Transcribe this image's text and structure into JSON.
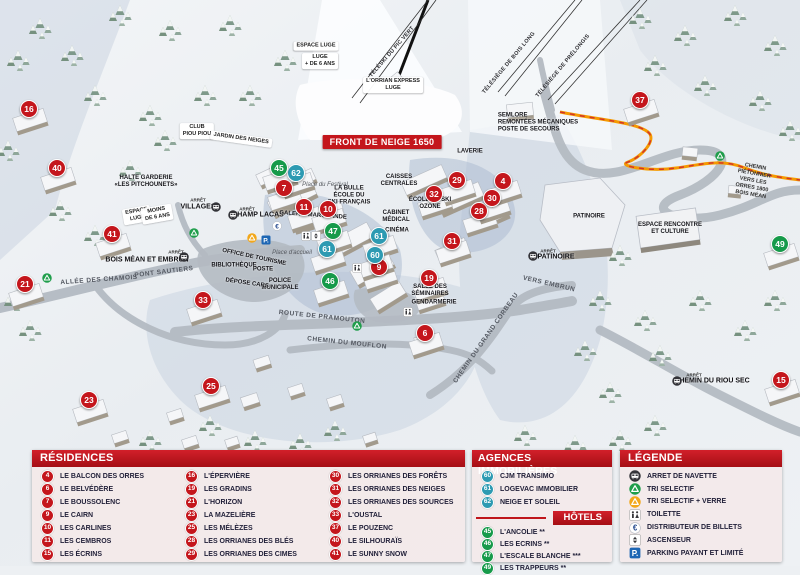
{
  "map": {
    "banner": "FRONT DE NEIGE 1650",
    "colors": {
      "residence": "#c4161c",
      "agency": "#2d9ab2",
      "hotel": "#169a4a",
      "header_red": "#b5121b",
      "path_orange": "#f59a00"
    },
    "markers": [
      {
        "n": "16",
        "type": "res",
        "x": 28,
        "y": 108
      },
      {
        "n": "40",
        "type": "res",
        "x": 56,
        "y": 167
      },
      {
        "n": "41",
        "type": "res",
        "x": 111,
        "y": 233
      },
      {
        "n": "21",
        "type": "res",
        "x": 24,
        "y": 283
      },
      {
        "n": "23",
        "type": "res",
        "x": 88,
        "y": 399
      },
      {
        "n": "25",
        "type": "res",
        "x": 210,
        "y": 385
      },
      {
        "n": "33",
        "type": "res",
        "x": 202,
        "y": 299
      },
      {
        "n": "7",
        "type": "res",
        "x": 283,
        "y": 187
      },
      {
        "n": "11",
        "type": "res",
        "x": 303,
        "y": 206
      },
      {
        "n": "10",
        "type": "res",
        "x": 327,
        "y": 208
      },
      {
        "n": "9",
        "type": "res",
        "x": 378,
        "y": 266
      },
      {
        "n": "6",
        "type": "res",
        "x": 424,
        "y": 332
      },
      {
        "n": "19",
        "type": "res",
        "x": 428,
        "y": 277
      },
      {
        "n": "32",
        "type": "res",
        "x": 433,
        "y": 193
      },
      {
        "n": "29",
        "type": "res",
        "x": 456,
        "y": 179
      },
      {
        "n": "31",
        "type": "res",
        "x": 451,
        "y": 240
      },
      {
        "n": "28",
        "type": "res",
        "x": 478,
        "y": 210
      },
      {
        "n": "30",
        "type": "res",
        "x": 491,
        "y": 197
      },
      {
        "n": "4",
        "type": "res",
        "x": 502,
        "y": 180
      },
      {
        "n": "37",
        "type": "res",
        "x": 639,
        "y": 99
      },
      {
        "n": "15",
        "type": "res",
        "x": 780,
        "y": 379
      },
      {
        "n": "62",
        "type": "agency",
        "x": 295,
        "y": 172
      },
      {
        "n": "61",
        "type": "agency",
        "x": 326,
        "y": 248
      },
      {
        "n": "61",
        "type": "agency",
        "x": 378,
        "y": 235
      },
      {
        "n": "60",
        "type": "agency",
        "x": 374,
        "y": 254
      },
      {
        "n": "45",
        "type": "hotel",
        "x": 278,
        "y": 167
      },
      {
        "n": "47",
        "type": "hotel",
        "x": 332,
        "y": 230
      },
      {
        "n": "46",
        "type": "hotel",
        "x": 329,
        "y": 280
      },
      {
        "n": "49",
        "type": "hotel",
        "x": 779,
        "y": 243
      }
    ],
    "labels": [
      {
        "text": "FRONT DE NEIGE 1650",
        "x": 382,
        "y": 142,
        "rot": 0,
        "cls": "banner"
      },
      {
        "text": "L'ORRIAN EXPRESS\nLUGE",
        "x": 393,
        "y": 85,
        "rot": 0,
        "cls": "pill"
      },
      {
        "text": "TÉLÉSKI DU PIC VERT",
        "x": 392,
        "y": 52,
        "rot": -49,
        "cls": "lift"
      },
      {
        "text": "TÉLÉSIÈGE DE BOIS LONG",
        "x": 509,
        "y": 63,
        "rot": -50,
        "cls": "lift"
      },
      {
        "text": "TÉLÉSIÈGE DE PRÉLONGIS",
        "x": 563,
        "y": 66,
        "rot": -50,
        "cls": "lift"
      },
      {
        "text": "SEMLORE\nREMONTÉES MÉCANIQUES\nPOSTE DE SECOURS",
        "x": 538,
        "y": 123,
        "rot": 0,
        "cls": "bold left"
      },
      {
        "text": "CLUB\nPIOU PIOU",
        "x": 197,
        "y": 131,
        "rot": 0,
        "cls": "pill"
      },
      {
        "text": "JARDIN DES NEIGES",
        "x": 241,
        "y": 139,
        "rot": 8,
        "cls": "pill"
      },
      {
        "text": "HALTE GARDERIE\n«LES PITCHOUNETS»",
        "x": 146,
        "y": 182,
        "rot": 0,
        "cls": "bold"
      },
      {
        "text": "ESPACE\nLUGE",
        "x": 137,
        "y": 215,
        "rot": -10,
        "cls": "pill"
      },
      {
        "text": "MOINS\nDE 6 ANS",
        "x": 157,
        "y": 214,
        "rot": -10,
        "cls": "pill"
      },
      {
        "text": "ESPACE LUGE",
        "x": 316,
        "y": 46,
        "rot": 0,
        "cls": "pill"
      },
      {
        "text": "LUGE\n+ DE 6 ANS",
        "x": 320,
        "y": 61,
        "rot": 0,
        "cls": "pill"
      },
      {
        "text": "ARRÊT",
        "x": 198,
        "y": 200,
        "rot": 0,
        "cls": "tiny"
      },
      {
        "text": "VILLAGES",
        "x": 198,
        "y": 207,
        "rot": 0,
        "cls": "stop"
      },
      {
        "text": "ARRÊT",
        "x": 247,
        "y": 209,
        "rot": 0,
        "cls": "tiny"
      },
      {
        "text": "CHAMP LACAS",
        "x": 258,
        "y": 215,
        "rot": 0,
        "cls": "stop"
      },
      {
        "text": "ARRÊT",
        "x": 176,
        "y": 252,
        "rot": 0,
        "cls": "tiny"
      },
      {
        "text": "BOIS MÉAN ET EMBRUN",
        "x": 147,
        "y": 260,
        "rot": 0,
        "cls": "stop"
      },
      {
        "text": "ARRÊT",
        "x": 548,
        "y": 251,
        "rot": 0,
        "cls": "tiny"
      },
      {
        "text": "PATINOIRE",
        "x": 556,
        "y": 257,
        "rot": 0,
        "cls": "stop"
      },
      {
        "text": "ARRÊT",
        "x": 694,
        "y": 375,
        "rot": 0,
        "cls": "tiny"
      },
      {
        "text": "CHEMIN DU RIOU SEC",
        "x": 712,
        "y": 381,
        "rot": 0,
        "cls": "stop"
      },
      {
        "text": "GALERIE MARCHANDE",
        "x": 313,
        "y": 216,
        "rot": 4,
        "cls": "bold"
      },
      {
        "text": "LA BULLE\nÉCOLE DU\nSKI FRANÇAIS",
        "x": 349,
        "y": 196,
        "rot": 0,
        "cls": "bold"
      },
      {
        "text": "Place du Festival",
        "x": 325,
        "y": 185,
        "rot": 0,
        "cls": "ital"
      },
      {
        "text": "Place d'accueil",
        "x": 292,
        "y": 253,
        "rot": 0,
        "cls": "ital"
      },
      {
        "text": "OFFICE DE TOURISME",
        "x": 254,
        "y": 258,
        "rot": 12,
        "cls": "bold"
      },
      {
        "text": "BIBLIOTHÈQUE",
        "x": 234,
        "y": 266,
        "rot": 0,
        "cls": "bold"
      },
      {
        "text": "POSTE",
        "x": 263,
        "y": 270,
        "rot": 0,
        "cls": "bold"
      },
      {
        "text": "POLICE\nMUNICIPALE",
        "x": 280,
        "y": 285,
        "rot": 0,
        "cls": "bold"
      },
      {
        "text": "DÉPOSE CARS",
        "x": 247,
        "y": 284,
        "rot": 8,
        "cls": "bold"
      },
      {
        "text": "ALLÉE DES CHAMOIS",
        "x": 99,
        "y": 280,
        "rot": -4,
        "cls": "road"
      },
      {
        "text": "PONT SAUTIERS",
        "x": 164,
        "y": 272,
        "rot": -7,
        "cls": "road"
      },
      {
        "text": "ROUTE DE PRAMOUTON",
        "x": 322,
        "y": 317,
        "rot": 6,
        "cls": "road"
      },
      {
        "text": "CHEMIN DU MOUFLON",
        "x": 347,
        "y": 343,
        "rot": 6,
        "cls": "road"
      },
      {
        "text": "CHEMIN DU GRAND CORBEAU",
        "x": 486,
        "y": 338,
        "rot": -55,
        "cls": "road"
      },
      {
        "text": "VERS EMBRUN",
        "x": 549,
        "y": 284,
        "rot": 13,
        "cls": "road"
      },
      {
        "text": "LAVERIE",
        "x": 470,
        "y": 152,
        "rot": 0,
        "cls": "bold"
      },
      {
        "text": "CAISSES\nCENTRALES",
        "x": 399,
        "y": 181,
        "rot": 0,
        "cls": "bold"
      },
      {
        "text": "ÉCOLE DE SKI\nOZONE",
        "x": 430,
        "y": 204,
        "rot": 0,
        "cls": "bold"
      },
      {
        "text": "CABINET\nMÉDICAL",
        "x": 396,
        "y": 217,
        "rot": 0,
        "cls": "bold"
      },
      {
        "text": "CINÉMA",
        "x": 397,
        "y": 231,
        "rot": 0,
        "cls": "bold"
      },
      {
        "text": "SALLE DES\nSÉMINAIRES",
        "x": 430,
        "y": 291,
        "rot": 0,
        "cls": "bold"
      },
      {
        "text": "GENDARMERIE",
        "x": 434,
        "y": 303,
        "rot": 0,
        "cls": "bold"
      },
      {
        "text": "PATINOIRE",
        "x": 589,
        "y": 217,
        "rot": 0,
        "cls": "bold"
      },
      {
        "text": "ESPACE RENCONTRE\nET CULTURE",
        "x": 670,
        "y": 229,
        "rot": 0,
        "cls": "bold"
      },
      {
        "text": "CHEMIN PIÉTONNIER\nVERS LES ORRES 1800\nBOIS MÉAN",
        "x": 753,
        "y": 181,
        "rot": 10,
        "cls": "tinyroad"
      }
    ],
    "icons": [
      {
        "name": "bus-icon",
        "x": 216,
        "y": 207
      },
      {
        "name": "bus-icon",
        "x": 233,
        "y": 215
      },
      {
        "name": "bus-icon",
        "x": 184,
        "y": 257
      },
      {
        "name": "bus-icon",
        "x": 533,
        "y": 256
      },
      {
        "name": "bus-icon",
        "x": 677,
        "y": 381
      },
      {
        "name": "recycle-green-icon",
        "x": 194,
        "y": 233
      },
      {
        "name": "recycle-green-icon",
        "x": 47,
        "y": 278
      },
      {
        "name": "recycle-green-icon",
        "x": 357,
        "y": 326
      },
      {
        "name": "recycle-green-icon",
        "x": 720,
        "y": 156
      },
      {
        "name": "recycle-yellow-icon",
        "x": 252,
        "y": 238
      },
      {
        "name": "parking-icon",
        "x": 266,
        "y": 240
      },
      {
        "name": "euro-icon",
        "x": 277,
        "y": 226
      },
      {
        "name": "wc-icon",
        "x": 306,
        "y": 236
      },
      {
        "name": "elevator-icon",
        "x": 316,
        "y": 236
      },
      {
        "name": "wc-icon",
        "x": 357,
        "y": 268
      },
      {
        "name": "wc-icon",
        "x": 408,
        "y": 312
      }
    ]
  },
  "panels": {
    "residences": {
      "title": "RÉSIDENCES",
      "columns": [
        [
          {
            "n": "4",
            "type": "res",
            "label": "LE BALCON DES ORRES"
          },
          {
            "n": "6",
            "type": "res",
            "label": "LE BELVÉDÈRE"
          },
          {
            "n": "7",
            "type": "res",
            "label": "LE BOUSSOLENC"
          },
          {
            "n": "9",
            "type": "res",
            "label": "LE CAIRN"
          },
          {
            "n": "10",
            "type": "res",
            "label": "LES CARLINES"
          },
          {
            "n": "11",
            "type": "res",
            "label": "LES CEMBROS"
          },
          {
            "n": "15",
            "type": "res",
            "label": "LES ÉCRINS"
          }
        ],
        [
          {
            "n": "16",
            "type": "res",
            "label": "L'ÉPERVIÈRE"
          },
          {
            "n": "19",
            "type": "res",
            "label": "LES GRADINS"
          },
          {
            "n": "21",
            "type": "res",
            "label": "L'HORIZON"
          },
          {
            "n": "23",
            "type": "res",
            "label": "LA MAZELIÈRE"
          },
          {
            "n": "25",
            "type": "res",
            "label": "LES MÉLÈZES"
          },
          {
            "n": "28",
            "type": "res",
            "label": "LES ORRIANES DES BLÉS"
          },
          {
            "n": "29",
            "type": "res",
            "label": "LES ORRIANES DES CIMES"
          }
        ],
        [
          {
            "n": "30",
            "type": "res",
            "label": "LES ORRIANES DES FORÊTS"
          },
          {
            "n": "31",
            "type": "res",
            "label": "LES ORRIANES DES NEIGES"
          },
          {
            "n": "32",
            "type": "res",
            "label": "LES ORRIANES DES SOURCES"
          },
          {
            "n": "33",
            "type": "res",
            "label": "L'OUSTAL"
          },
          {
            "n": "37",
            "type": "res",
            "label": "LE POUZENC"
          },
          {
            "n": "40",
            "type": "res",
            "label": "LE SILHOURAÏS"
          },
          {
            "n": "41",
            "type": "res",
            "label": "LE SUNNY SNOW"
          }
        ]
      ]
    },
    "agences": {
      "title": "AGENCES IMMOBILIÈRES",
      "items": [
        {
          "n": "60",
          "type": "agency",
          "label": "CJM TRANSIMO"
        },
        {
          "n": "61",
          "type": "agency",
          "label": "LOGEVAC IMMOBILIER"
        },
        {
          "n": "62",
          "type": "agency",
          "label": "NEIGE ET SOLEIL"
        }
      ]
    },
    "hotels": {
      "title": "HÔTELS",
      "items": [
        {
          "n": "45",
          "type": "hotel",
          "label": "L'ANCOLIE **"
        },
        {
          "n": "46",
          "type": "hotel",
          "label": "LES ECRINS **"
        },
        {
          "n": "47",
          "type": "hotel",
          "label": "L'ESCALE BLANCHE ***"
        },
        {
          "n": "49",
          "type": "hotel",
          "label": "LES TRAPPEURS **"
        }
      ]
    },
    "legende": {
      "title": "LÉGENDE",
      "items": [
        {
          "icon": "bus-icon",
          "label": "ARRET DE NAVETTE"
        },
        {
          "icon": "recycle-green-icon",
          "label": "TRI SELECTIF"
        },
        {
          "icon": "recycle-yellow-icon",
          "label": "TRI SELECTIF + VERRE"
        },
        {
          "icon": "wc-icon",
          "label": "TOILETTE"
        },
        {
          "icon": "euro-icon",
          "label": "DISTRIBUTEUR DE BILLETS"
        },
        {
          "icon": "elevator-icon",
          "label": "ASCENSEUR"
        },
        {
          "icon": "parking-icon",
          "label": "PARKING PAYANT ET LIMITÉ"
        }
      ]
    }
  }
}
